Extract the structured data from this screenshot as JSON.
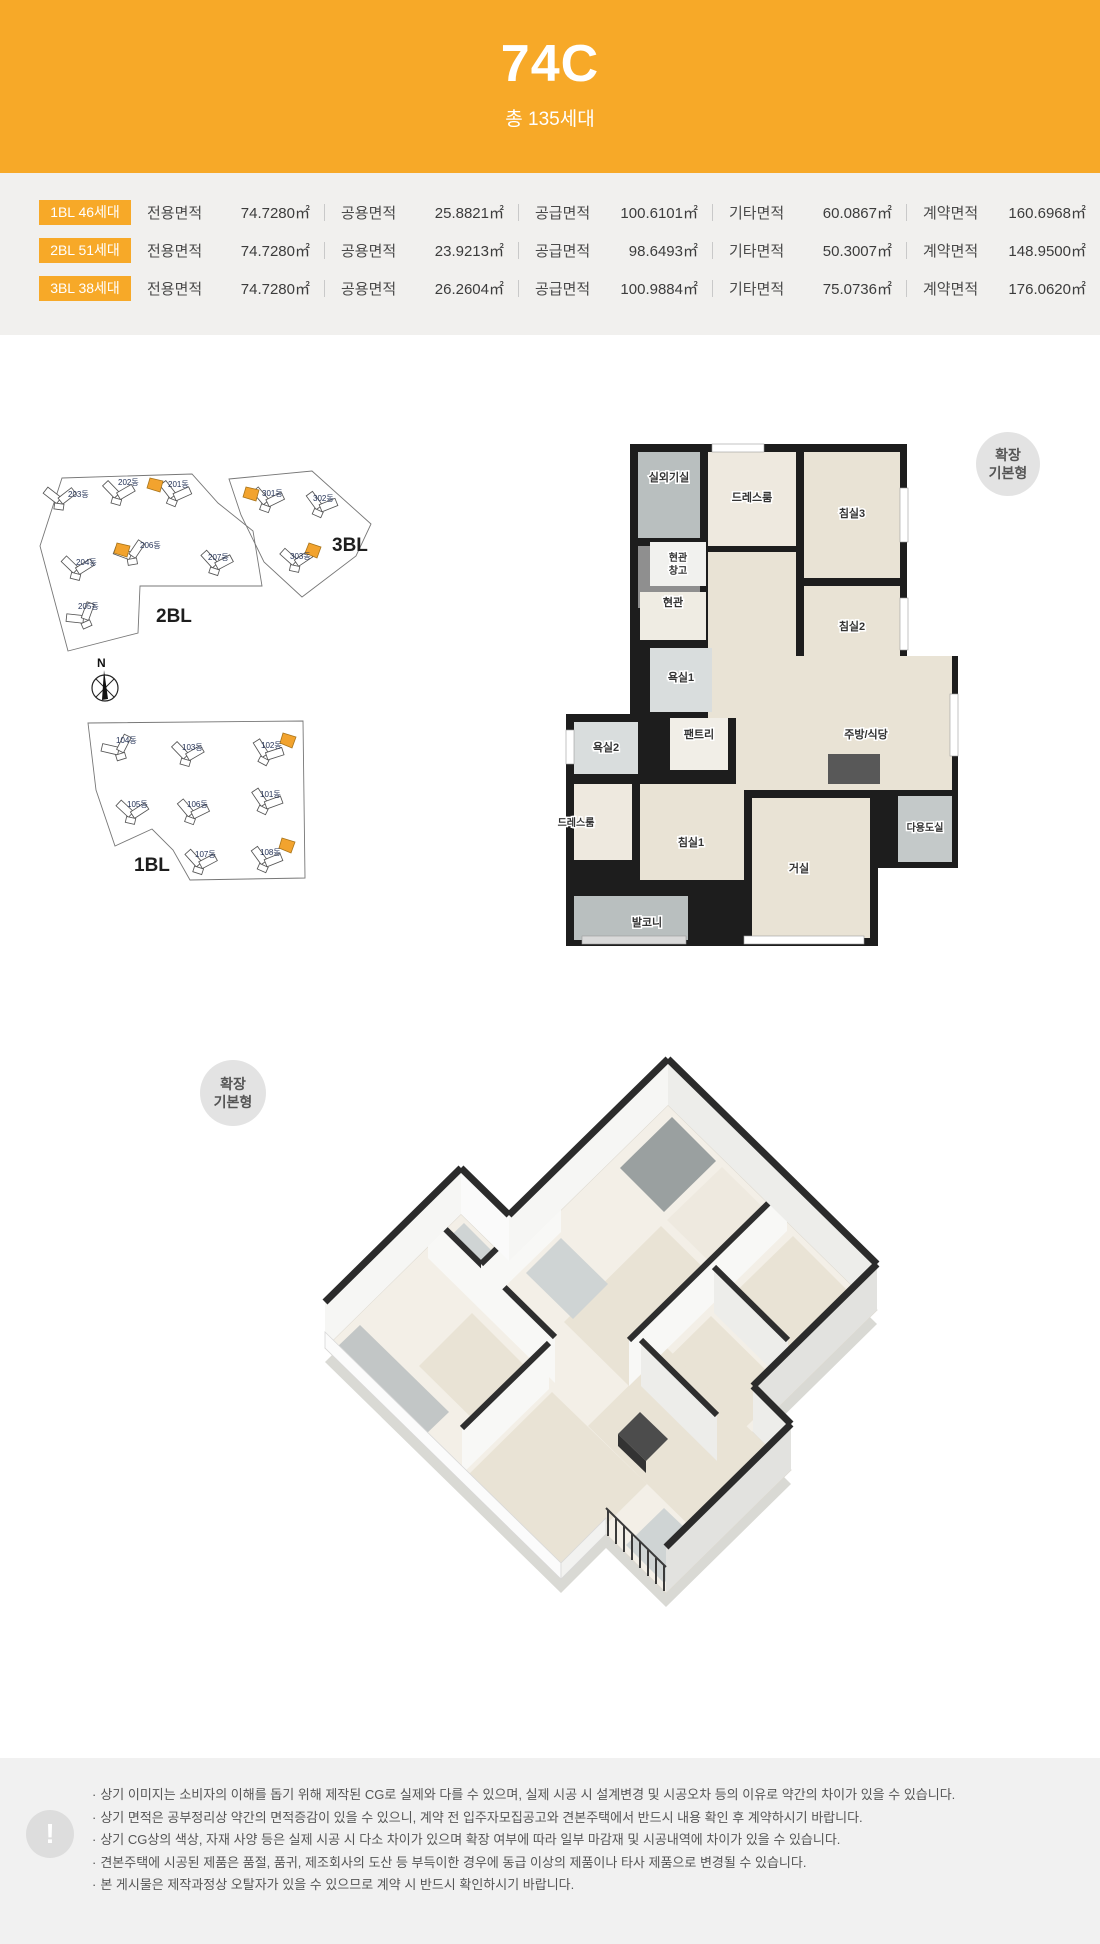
{
  "header": {
    "title": "74C",
    "subtitle": "총 135세대"
  },
  "spec_rows": [
    {
      "badge": "1BL 46세대",
      "cols": [
        {
          "label": "전용면적",
          "value": "74.7280㎡"
        },
        {
          "label": "공용면적",
          "value": "25.8821㎡"
        },
        {
          "label": "공급면적",
          "value": "100.6101㎡"
        },
        {
          "label": "기타면적",
          "value": "60.0867㎡"
        },
        {
          "label": "계약면적",
          "value": "160.6968㎡"
        }
      ]
    },
    {
      "badge": "2BL 51세대",
      "cols": [
        {
          "label": "전용면적",
          "value": "74.7280㎡"
        },
        {
          "label": "공용면적",
          "value": "23.9213㎡"
        },
        {
          "label": "공급면적",
          "value": "98.6493㎡"
        },
        {
          "label": "기타면적",
          "value": "50.3007㎡"
        },
        {
          "label": "계약면적",
          "value": "148.9500㎡"
        }
      ]
    },
    {
      "badge": "3BL 38세대",
      "cols": [
        {
          "label": "전용면적",
          "value": "74.7280㎡"
        },
        {
          "label": "공용면적",
          "value": "26.2604㎡"
        },
        {
          "label": "공급면적",
          "value": "100.9884㎡"
        },
        {
          "label": "기타면적",
          "value": "75.0736㎡"
        },
        {
          "label": "계약면적",
          "value": "176.0620㎡"
        }
      ]
    }
  ],
  "site_plan": {
    "compass": "N",
    "block_2bl": {
      "label": "2BL",
      "b201": "201동",
      "b202": "202동",
      "b203": "203동",
      "b204": "204동",
      "b205": "205동",
      "b206": "206동",
      "b207": "207동"
    },
    "block_3bl": {
      "label": "3BL",
      "b301": "301동",
      "b302": "302동",
      "b303": "303동"
    },
    "block_1bl": {
      "label": "1BL",
      "b101": "101동",
      "b102": "102동",
      "b103": "103동",
      "b104": "104동",
      "b105": "105동",
      "b106": "106동",
      "b107": "107동",
      "b108": "108동"
    }
  },
  "floor_plan": {
    "badge_line1": "확장",
    "badge_line2": "기본형",
    "rooms": {
      "outdoor_unit": "실외기실",
      "dressroom_top": "드레스룸",
      "bedroom3": "침실3",
      "entry_storage1": "현관",
      "entry_storage2": "창고",
      "entrance": "현관",
      "bedroom2": "침실2",
      "bathroom1": "욕실1",
      "bathroom2": "욕실2",
      "pantry": "팬트리",
      "kitchen": "주방/식당",
      "dressroom_left": "드레스룸",
      "bedroom1": "침실1",
      "living": "거실",
      "utility": "다용도실",
      "balcony": "발코니"
    }
  },
  "colors": {
    "accent": "#F7A928",
    "band_bg": "#F1F0EE",
    "highlight_unit": "#F2A32E"
  },
  "disclaimer": {
    "bullet": "·",
    "icon": "!",
    "items": [
      "상기 이미지는 소비자의 이해를 돕기 위해 제작된 CG로 실제와 다를 수 있으며, 실제 시공 시 설계변경 및 시공오차 등의 이유로 약간의 차이가 있을 수 있습니다.",
      "상기 면적은 공부정리상 약간의 면적증감이 있을 수 있으니, 계약 전 입주자모집공고와 견본주택에서 반드시 내용 확인 후 계약하시기 바랍니다.",
      "상기 CG상의 색상, 자재 사양 등은 실제 시공 시 다소 차이가 있으며 확장 여부에 따라 일부 마감재 및 시공내역에 차이가 있을 수 있습니다.",
      "견본주택에 시공된 제품은 품절, 품귀, 제조회사의 도산 등 부득이한 경우에 동급 이상의 제품이나 타사 제품으로 변경될 수 있습니다.",
      "본 게시물은 제작과정상 오탈자가 있을 수 있으므로 계약 시 반드시 확인하시기 바랍니다."
    ]
  }
}
